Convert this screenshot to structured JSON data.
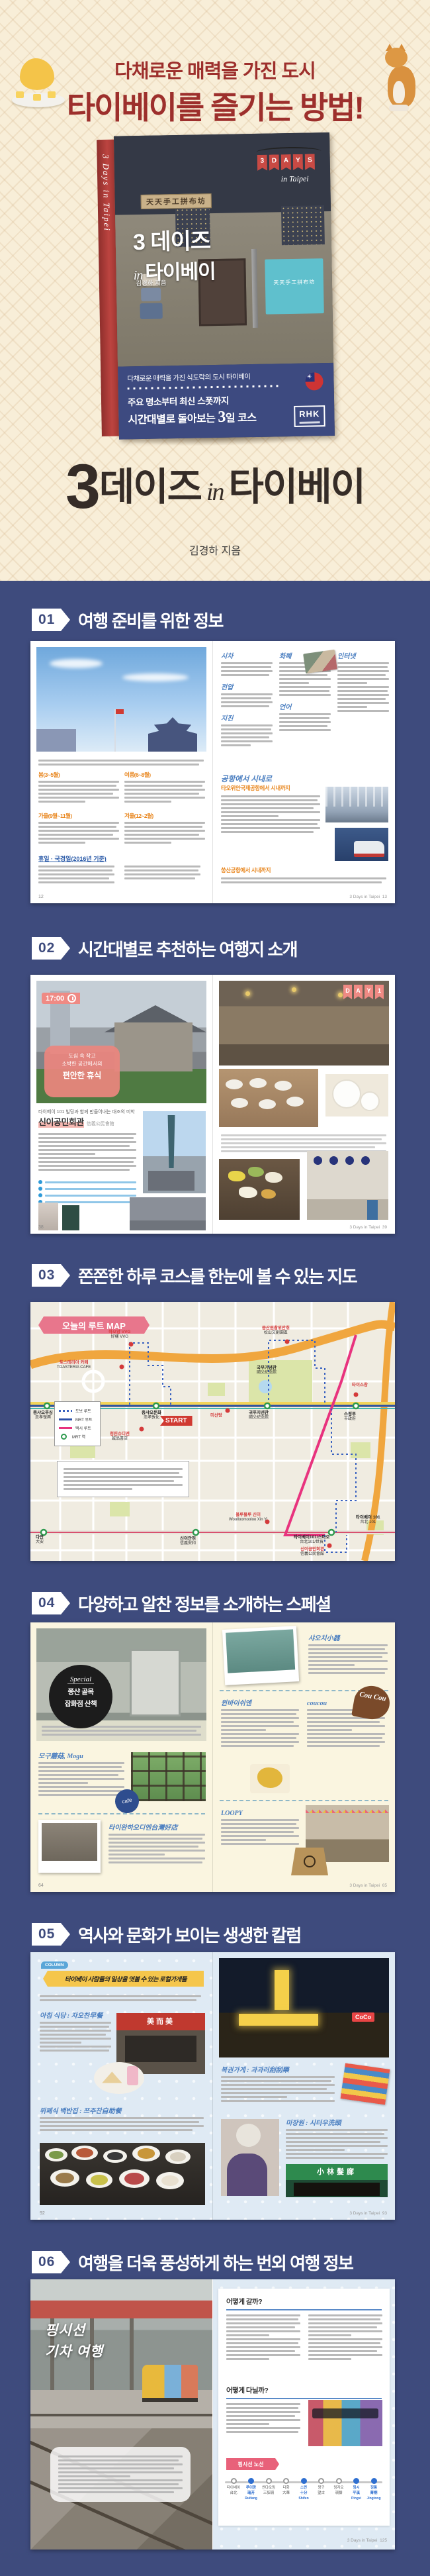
{
  "header": {
    "line1": "다채로운 매력을 가진 도시",
    "line2": "타이베이를 즐기는 방법!"
  },
  "book": {
    "spine": "3 Days in Taipei",
    "flags": [
      "3",
      "D",
      "A",
      "Y",
      "S"
    ],
    "flags_sub": "in Taipei",
    "shop_sign": "天天手工拼布坊",
    "title_num": "3",
    "title_word": "데이즈",
    "title_in": "in",
    "title_city": "타이베이",
    "author": "김경하 지음",
    "band1": "다채로운 매력을 가진 식도락의 도시 타이베이",
    "band2": "주요 명소부터 최신 스폿까지",
    "band3a": "시간대별로 돌아보는",
    "band3num": "3",
    "band3b": "일 코스",
    "publisher": "RHK",
    "accent_red": "#bc4440",
    "cover_navy": "#3d4a80"
  },
  "main_title": {
    "num": "3",
    "word1": "데이즈",
    "inword": "in",
    "word2": "타이베이",
    "author": "김경하 지음"
  },
  "sections": [
    {
      "num": "01",
      "title": "여행 준비를 위한 정보"
    },
    {
      "num": "02",
      "title": "시간대별로 추천하는 여행지 소개"
    },
    {
      "num": "03",
      "title": "쫀쫀한 하루 코스를 한눈에 볼 수 있는 지도"
    },
    {
      "num": "04",
      "title": "다양하고 알찬 정보를 소개하는 스페셜"
    },
    {
      "num": "05",
      "title": "역사와 문화가 보이는 생생한 칼럼"
    },
    {
      "num": "06",
      "title": "여행을 더욱 풍성하게 하는 번외 여행 정보"
    }
  ],
  "s1": {
    "h_sicha": "시차",
    "h_jeonap": "전압",
    "h_jijin": "지진",
    "h_hwapye": "화폐",
    "h_eoneo": "언어",
    "h_internet": "인터넷",
    "season1": "봄(3~5월)",
    "season2": "여름(6~8월)",
    "season3": "가을(9월~11월)",
    "season4": "겨울(12~2월)",
    "holidays": "휴일 · 국경일(2016년 기준)",
    "airport": "공항에서 시내로",
    "airport_sub1": "타오위안국제공항에서 시내까지",
    "airport_sub2": "쑹산공항에서 시내까지",
    "pgl": "12",
    "pgr": "13",
    "brand": "3 Days in Taipei"
  },
  "s2": {
    "time": "17:00",
    "ov1": "도심 속 작고",
    "ov2": "소박한 공간에서의",
    "ov3": "편안한 휴식",
    "day": [
      "D",
      "A",
      "Y",
      "1"
    ],
    "intro": "타이베이 101 빌딩과 함께 만들어내는 대조의 미학",
    "place": "신이공민회관",
    "place_hanzi": "信義公民會館",
    "pgl": "38",
    "pgr": "39",
    "brand": "3 Days in Taipei"
  },
  "s3": {
    "banner": "오늘의 루트 MAP",
    "start": "START",
    "legend": [
      "도보 루트",
      "MRT 루트",
      "택시 루트",
      "MRT 역"
    ],
    "labels": [
      {
        "ko": "하오양 VVG",
        "sub": "好樣 VVG"
      },
      {
        "ko": "토스테리아 카페",
        "sub": "TOASTERIA CAFE"
      },
      {
        "ko": "쑹산원촹위안취",
        "sub": "松山文創園區"
      },
      {
        "ko": "중샤오푸싱",
        "sub": "忠孝復興"
      },
      {
        "ko": "중샤오둔화",
        "sub": "忠孝敦化"
      },
      {
        "ko": "궈푸지녠관",
        "sub": "國父紀念館"
      },
      {
        "ko": "스정푸",
        "sub": "市政府"
      },
      {
        "ko": "청핀슈디엔",
        "sub": "誠品書店"
      },
      {
        "ko": "미산탕",
        "sub": ""
      },
      {
        "ko": "국부기념관",
        "sub": "國父紀念館"
      },
      {
        "ko": "타이스창",
        "sub": ""
      },
      {
        "ko": "울루물루 신이",
        "sub": "Woolloomooloo Xin Yi"
      },
      {
        "ko": "타이베이101/스마오",
        "sub": "台北101/世貿"
      },
      {
        "ko": "타이베이 101",
        "sub": "台北 101"
      },
      {
        "ko": "다안",
        "sub": "大安"
      },
      {
        "ko": "신이안허",
        "sub": "信義安和"
      },
      {
        "ko": "신이공민회관",
        "sub": "信義公民會館"
      }
    ]
  },
  "s4": {
    "badge_script": "Special",
    "badge_l1": "쭝샨 골목",
    "badge_l2": "잡화점 산책",
    "e1": "모구",
    "e1s": "蘑菇, Mogu",
    "e2": "타이완하오디엔",
    "e2s": "台灣好店",
    "e3": "샤오치",
    "e3s": "小器",
    "e4": "윈바이쉬엔",
    "e5": "coucou",
    "e6": "LOOPY",
    "sticker": "cafe",
    "bubble": "Cou Cou",
    "pgl": "64",
    "pgr": "65",
    "brand": "3 Days in Taipei"
  },
  "s5": {
    "bubble": "COLUMN",
    "ribbon": "타이베이 사람들의 일상을 엿볼 수 있는 로컬가게들",
    "e1": "아침 식당 : 자오찬",
    "e1s": "早餐",
    "e2": "복권가게 : 과과러",
    "e2s": "刮刮樂",
    "e3": "뷔페식 백반집 : 쯔주찬",
    "e3s": "自助餐",
    "e4": "미장원 : 시터우",
    "e4s": "洗頭",
    "sign1": "美而美",
    "sign2": "CoCo",
    "sign3": "小林髮廊",
    "pgl": "92",
    "pgr": "93",
    "brand": "3 Days in Taipei"
  },
  "s6": {
    "script1": "핑시선",
    "script2": "기차 여행",
    "q1": "어떻게 갈까?",
    "q2": "어떻게 다닐까?",
    "badge": "핑시선 노선",
    "stations": [
      {
        "ko": "타이베이",
        "hz": "台北",
        "ro": ""
      },
      {
        "ko": "루이팡",
        "hz": "瑞芳",
        "ro": "Ruifang"
      },
      {
        "ko": "싼댜오링",
        "hz": "三貂嶺",
        "ro": ""
      },
      {
        "ko": "다화",
        "hz": "大華",
        "ro": ""
      },
      {
        "ko": "스펀",
        "hz": "十分",
        "ro": "Shifen"
      },
      {
        "ko": "왕구",
        "hz": "望古",
        "ro": ""
      },
      {
        "ko": "링자오",
        "hz": "嶺腳",
        "ro": ""
      },
      {
        "ko": "핑시",
        "hz": "平溪",
        "ro": "Pingxi"
      },
      {
        "ko": "징퉁",
        "hz": "菁桐",
        "ro": "Jingtong"
      }
    ],
    "pgr": "125",
    "brand": "3 Days in Taipei"
  }
}
